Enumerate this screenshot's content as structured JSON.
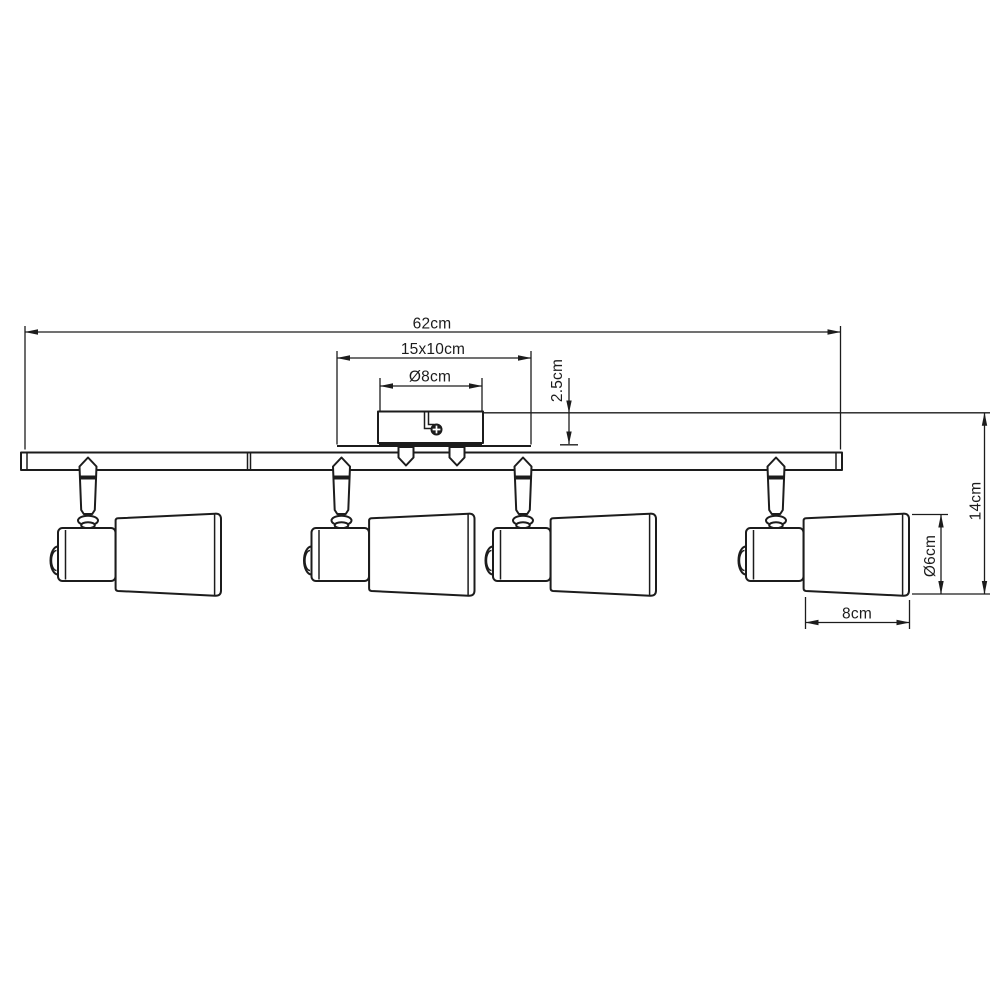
{
  "meta": {
    "background_color": "#ffffff",
    "line_color": "#1c1c1c",
    "canvas_width": 1000,
    "canvas_height": 1000
  },
  "dimensions": {
    "overall_width": "62cm",
    "canopy_plate": "15x10cm",
    "canopy_diameter": "Ø8cm",
    "canopy_height": "2.5cm",
    "total_height": "14cm",
    "shade_diameter": "Ø6cm",
    "shade_length": "8cm"
  }
}
